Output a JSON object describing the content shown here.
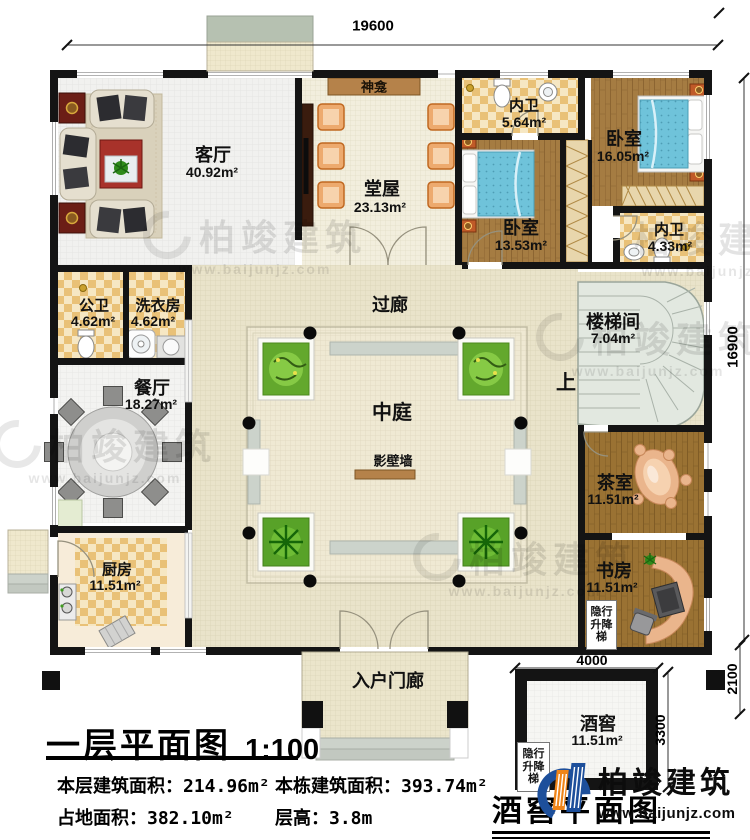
{
  "titles": {
    "main": "一层平面图",
    "scale": "1:100",
    "cellar": "酒窖平面图"
  },
  "stats": [
    {
      "label": "本层建筑面积：",
      "value": "214.96m²"
    },
    {
      "label": "本栋建筑面积：",
      "value": "393.74m²"
    },
    {
      "label": "占地面积：",
      "value": "382.10m²"
    },
    {
      "label": "层高：",
      "value": "3.8m"
    }
  ],
  "rooms": {
    "living": {
      "name": "客厅",
      "area": "40.92m²"
    },
    "hall": {
      "name": "堂屋",
      "area": "23.13m²"
    },
    "shrine": {
      "name": "神龛"
    },
    "bath_top": {
      "name": "内卫",
      "area": "5.64m²"
    },
    "bedroom_right": {
      "name": "卧室",
      "area": "16.05m²"
    },
    "bedroom_left": {
      "name": "卧室",
      "area": "13.53m²"
    },
    "bath_right": {
      "name": "内卫",
      "area": "4.33m²"
    },
    "public_bath": {
      "name": "公卫",
      "area": "4.62m²"
    },
    "laundry": {
      "name": "洗衣房",
      "area": "4.62m²"
    },
    "dining": {
      "name": "餐厅",
      "area": "18.27m²"
    },
    "corridor": {
      "name": "过廊"
    },
    "atrium": {
      "name": "中庭"
    },
    "screen_wall": {
      "name": "影壁墙"
    },
    "stairwell": {
      "name": "楼梯间",
      "area": "7.04m²"
    },
    "up": {
      "name": "上"
    },
    "tea": {
      "name": "茶室",
      "area": "11.51m²"
    },
    "kitchen": {
      "name": "厨房",
      "area": "11.51m²"
    },
    "study": {
      "name": "书房",
      "area": "11.51m²"
    },
    "porch": {
      "name": "入户门廊"
    },
    "cellar": {
      "name": "酒窖",
      "area": "11.51m²"
    },
    "lift": {
      "name": "隐行升降梯"
    }
  },
  "dimensions": {
    "overall_width": "19600",
    "overall_height": "16900",
    "cellar_width": "4000",
    "cellar_height": "3300",
    "cellar_side": "2100"
  },
  "branding": {
    "brand": "柏竣建筑",
    "url": "www.baijunjz.com"
  },
  "colors": {
    "wall": "#141414",
    "wood": "#a57c42",
    "tan_floor": "#e9e3ca",
    "checker": "#e9c177",
    "accent_blue": "#1d4f9b",
    "accent_orange": "#f08519"
  }
}
